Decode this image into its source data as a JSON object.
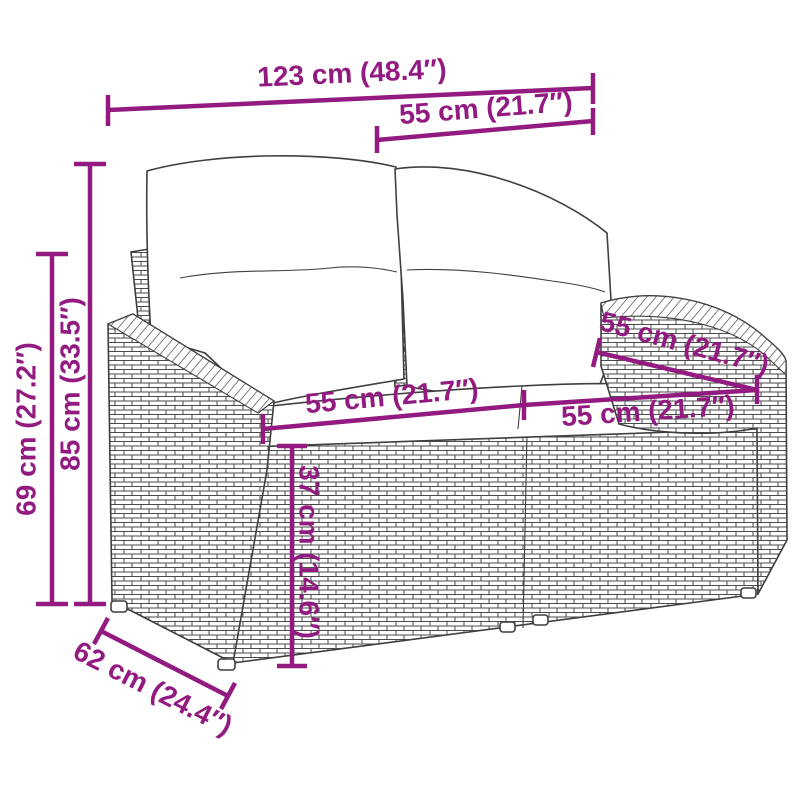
{
  "meta": {
    "accent_color": "#921A80",
    "artwork_line_color": "#3f3f3f",
    "background_color": "#ffffff"
  },
  "illustration": {
    "name": "poly-rattan-2-seater-garden-bench-with-back-and-seat-cushions"
  },
  "dimensions": {
    "total_width": {
      "cm": "123",
      "inch": "48.4",
      "label": "123 cm (48.4″)"
    },
    "backrest_width": {
      "cm": "55",
      "inch": "21.7",
      "label": "55 cm (21.7″)"
    },
    "total_height": {
      "cm": "85",
      "inch": "33.5",
      "label": "85 cm (33.5″)"
    },
    "armrest_height": {
      "cm": "69",
      "inch": "27.2",
      "label": "69 cm (27.2″)"
    },
    "seat_width_left": {
      "cm": "55",
      "inch": "21.7",
      "label": "55 cm (21.7″)"
    },
    "backrest_depth_top": {
      "cm": "55",
      "inch": "21.7",
      "label": "55 cm (21.7″)"
    },
    "seat_width_right": {
      "cm": "55",
      "inch": "21.7",
      "label": "55 cm (21.7″)"
    },
    "seat_height": {
      "cm": "37",
      "inch": "14.6",
      "label": "37 cm (14.6″)"
    },
    "base_depth": {
      "cm": "62",
      "inch": "24.4",
      "label": "62 cm (24.4″)"
    }
  }
}
